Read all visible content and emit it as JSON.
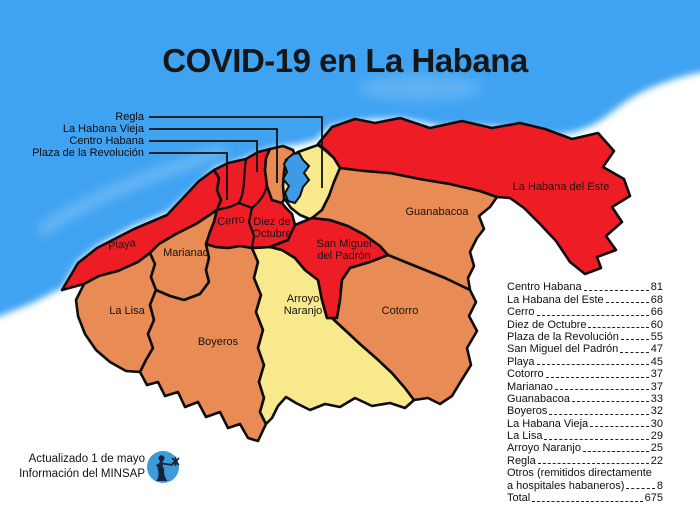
{
  "title": "COVID-19 en La Habana",
  "colors": {
    "sea": "#41a3f2",
    "high": "#ee1c25",
    "medium": "#e98b55",
    "low": "#f7e98c",
    "bay": "#3e9ae4",
    "outline": "#0d0d0d",
    "logo_blue": "#3c9bd8",
    "logo_figure": "#15233f"
  },
  "callouts": [
    {
      "label": "Regla"
    },
    {
      "label": "La Habana Vieja"
    },
    {
      "label": "Centro Habana"
    },
    {
      "label": "Plaza de la Revolución"
    }
  ],
  "map": {
    "regions": {
      "playa": {
        "label": "Playa",
        "level": "high"
      },
      "marianao": {
        "label": "Marianao",
        "level": "medium"
      },
      "la_lisa": {
        "label": "La Lisa",
        "level": "medium"
      },
      "boyeros": {
        "label": "Boyeros",
        "level": "medium"
      },
      "cerro": {
        "label": "Cerro",
        "level": "high"
      },
      "diez_de_octubre": {
        "label": "Diez de\nOctubre",
        "level": "high"
      },
      "arroyo_naranjo": {
        "label": "Arroyo\nNaranjo",
        "level": "low"
      },
      "san_miguel": {
        "label": "San Miguel\ndel Padrón",
        "level": "high"
      },
      "guanabacoa": {
        "label": "Guanabacoa",
        "level": "medium"
      },
      "cotorro": {
        "label": "Cotorro",
        "level": "medium"
      },
      "habana_del_este": {
        "label": "La Habana del Este",
        "level": "high"
      },
      "regla": {
        "label": "",
        "level": "low"
      },
      "habana_vieja": {
        "label": "",
        "level": "medium"
      },
      "centro_habana": {
        "label": "",
        "level": "high"
      },
      "plaza": {
        "label": "",
        "level": "high"
      }
    }
  },
  "stats": {
    "items": [
      {
        "name": "Centro Habana",
        "value": "81"
      },
      {
        "name": "La Habana del Este",
        "value": "68"
      },
      {
        "name": "Cerro",
        "value": "66"
      },
      {
        "name": "Diez de Octubre",
        "value": "60"
      },
      {
        "name": "Plaza de la Revolución",
        "value": "55"
      },
      {
        "name": "San Miguel del Padrón",
        "value": "47"
      },
      {
        "name": "Playa",
        "value": "45"
      },
      {
        "name": "Cotorro",
        "value": "37"
      },
      {
        "name": "Marianao",
        "value": "37"
      },
      {
        "name": "Guanabacoa",
        "value": "33"
      },
      {
        "name": "Boyeros",
        "value": "32"
      },
      {
        "name": "La Habana Vieja",
        "value": "30"
      },
      {
        "name": "La Lisa",
        "value": "29"
      },
      {
        "name": "Arroyo Naranjo",
        "value": "25"
      },
      {
        "name": "Regla",
        "value": "22"
      }
    ],
    "otros_line1": "Otros (remitidos directamente",
    "otros_line2": "a hospitales habaneros)",
    "otros_value": "8",
    "total_label": "Total",
    "total_value": "675"
  },
  "footer": {
    "line1": "Actualizado 1 de mayo",
    "line2": "Información del MINSAP"
  }
}
